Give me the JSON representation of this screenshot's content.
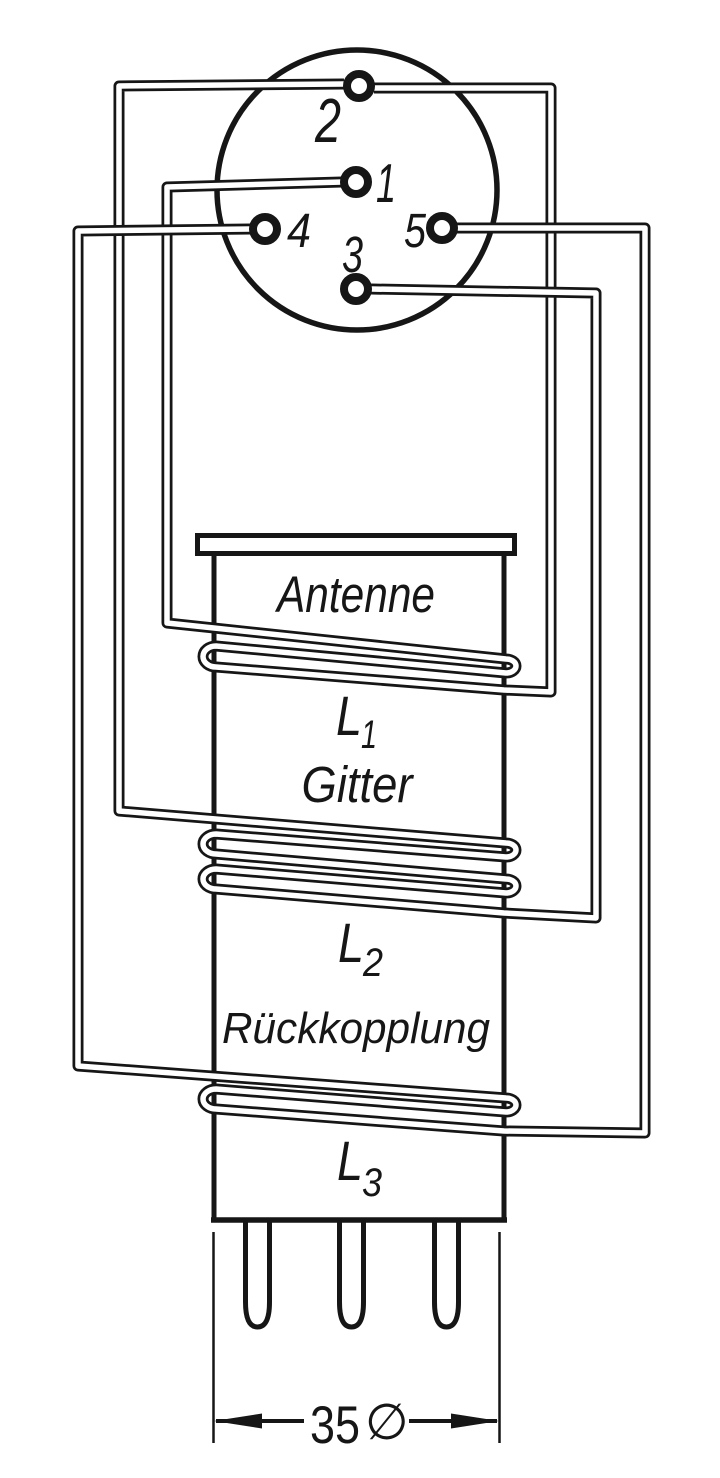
{
  "diagram_type": "coil-winding-plan",
  "colors": {
    "ink": "#161616",
    "background": "#ffffff"
  },
  "socket": {
    "pins": [
      {
        "id": "pin-1",
        "label": "1"
      },
      {
        "id": "pin-2",
        "label": "2"
      },
      {
        "id": "pin-3",
        "label": "3"
      },
      {
        "id": "pin-4",
        "label": "4"
      },
      {
        "id": "pin-5",
        "label": "5"
      }
    ]
  },
  "coil_former": {
    "sections": [
      {
        "winding_label": "Antenne",
        "coil_main": "L",
        "coil_sub": "1"
      },
      {
        "winding_label": "Gitter",
        "coil_main": "L",
        "coil_sub": "2"
      },
      {
        "winding_label": "Rückkopplung",
        "coil_main": "L",
        "coil_sub": "3"
      }
    ]
  },
  "dimension": {
    "value": "35",
    "symbol": "∅"
  },
  "connections": [
    {
      "winding": "L1 Antenne",
      "from": "pin 1",
      "to": "pin 2"
    },
    {
      "winding": "L2 Gitter",
      "from": "pin 2",
      "to": "pin 3"
    },
    {
      "winding": "L3 Rückkopplung",
      "from": "pin 4",
      "to": "pin 5"
    }
  ]
}
